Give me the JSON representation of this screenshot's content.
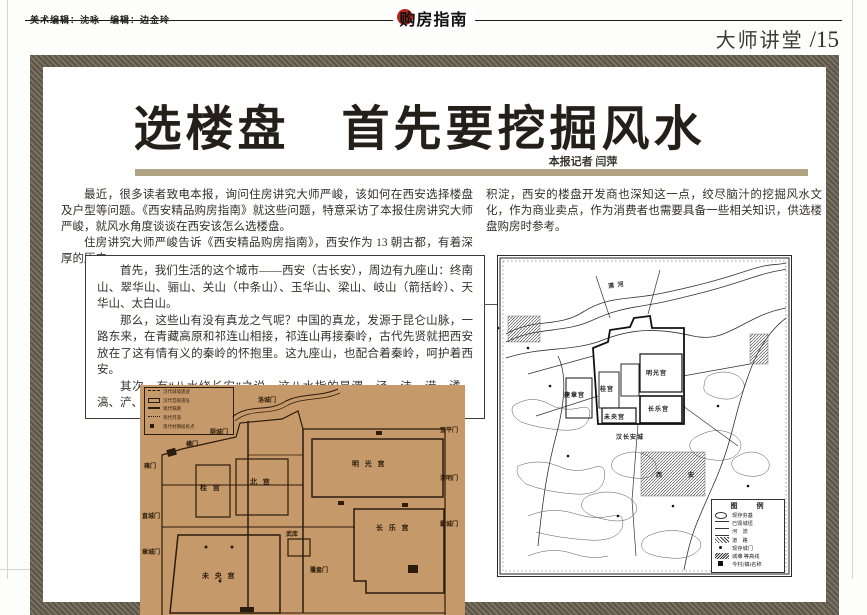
{
  "colors": {
    "frame_taupe": "#6b6254",
    "divider_tan": "#b1a485",
    "map_tan": "#c6996a",
    "masthead_red": "#b5241e",
    "map_ink": "#2b1c0c"
  },
  "header": {
    "editors": "美术编辑：沈咏　编辑：边金玲",
    "masthead": "购房指南",
    "section": "大师讲堂",
    "page_no": "/15"
  },
  "article": {
    "title": "选楼盘　首先要挖掘风水",
    "byline": "本报记者 闫萍",
    "para1": "最近，很多读者致电本报，询问住房讲究大师严峻，该如何在西安选择楼盘及户型等问题。《西安精品购房指南》就这些问题，特意采访了本报住房讲究大师严峻，就风水角度谈谈在西安该怎么选楼盘。",
    "para2": "住房讲究大师严峻告诉《西安精品购房指南》，西安作为 13 朝古都，有着深厚的历史",
    "para3": "积淀，西安的楼盘开发商也深知这一点，绞尽脑汁的挖掘风水文化，作为商业卖点，作为消费者也需要具备一些相关知识，供选楼盘购房时参考。",
    "box": {
      "p1": "首先，我们生活的这个城市——西安（古长安），周边有九座山：终南山、翠华山、骊山、关山（中条山）、玉华山、梁山、岐山（箭括岭）、天华山、太白山。",
      "p2": "那么，这些山有没有真龙之气呢？中国的真龙，发源于昆仑山脉，一路东来，在青藏高原和祁连山相接，祁连山再接秦岭，古代先贤就把西安放在了这有情有义的秦岭的怀抱里。这九座山，也配合着秦岭，呵护着西安。",
      "p3": "其次，有“八水绕长安”之说。这八水指的是渭、泾、沣、涝、潏、滈、浐、灞八条河流，它们在西安城四周穿流，均属黄河水系。"
    }
  },
  "left_map": {
    "legend": [
      "汉代城墙遗迹",
      "汉代宫殿遗址",
      "现代铁路",
      "现代河道",
      "现代村镇居民点"
    ],
    "labels": {
      "luochengmen": "洛城门",
      "chuchengmen": "厨城门",
      "hengmen": "横门",
      "xuanpingmen": "宣平门",
      "yongmen": "雍门",
      "mingguanggong": "明 光 宫",
      "guigong": "桂 宫",
      "beigong": "北 宫",
      "qingmingmen": "清明门",
      "zhichengmen": "直城门",
      "changlegong": "长 乐 宫",
      "bachengmen": "霸城门",
      "wuku": "武库",
      "weiyanggong": "未 央 宫",
      "zhangchengmen": "章城门",
      "fuangmen": "覆盎门"
    }
  },
  "right_map": {
    "labels": {
      "weihe": "渭 河",
      "jianzhanggong": "建章宫",
      "guigong": "桂宫",
      "mingguanggong": "明光宫",
      "changlegong": "长乐宫",
      "weiyanggong": "未央宫",
      "hancheng": "汉长安城",
      "xian": "西　安"
    },
    "legend_title": "图　例",
    "legend": [
      "现存夯基",
      "已毁城垣",
      "河　流",
      "道　路",
      "现存城门",
      "城壕 等高线",
      "今村(镇)名称"
    ]
  }
}
